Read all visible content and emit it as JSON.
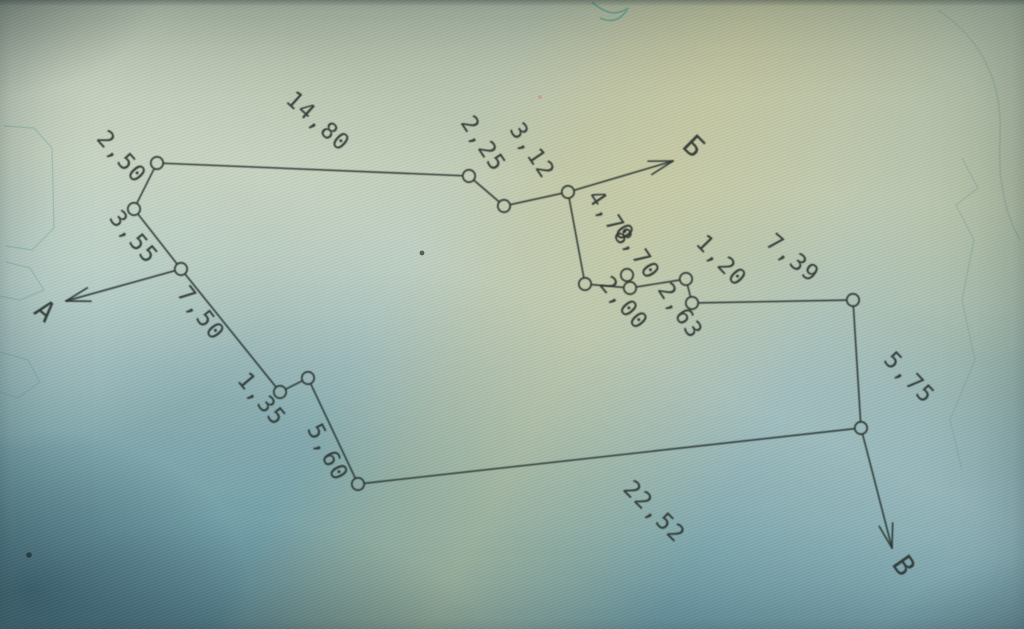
{
  "photo": {
    "ink_color": "#2c3531",
    "faint_mark_color": "#5f9e9b",
    "paper_tints": {
      "top_sage": "#bfcab4",
      "yellow_band": "#d3ca8e",
      "bottom_teal": "#6c98a3",
      "corner_shadow": "#102e3c"
    }
  },
  "diagram": {
    "type": "survey-traverse-sketch",
    "nodes": [
      {
        "id": "n1",
        "x": 157,
        "y": 163
      },
      {
        "id": "n2",
        "x": 134,
        "y": 209
      },
      {
        "id": "n3",
        "x": 181,
        "y": 269
      },
      {
        "id": "n4",
        "x": 469,
        "y": 176
      },
      {
        "id": "n5",
        "x": 504,
        "y": 206
      },
      {
        "id": "n6",
        "x": 568,
        "y": 192
      },
      {
        "id": "n7",
        "x": 585,
        "y": 284
      },
      {
        "id": "n8",
        "x": 627,
        "y": 275
      },
      {
        "id": "n9",
        "x": 630,
        "y": 288
      },
      {
        "id": "n10",
        "x": 686,
        "y": 279
      },
      {
        "id": "n11",
        "x": 692,
        "y": 303
      },
      {
        "id": "n12",
        "x": 853,
        "y": 300
      },
      {
        "id": "n13",
        "x": 861,
        "y": 428
      },
      {
        "id": "n14",
        "x": 280,
        "y": 392
      },
      {
        "id": "n15",
        "x": 308,
        "y": 378
      },
      {
        "id": "n16",
        "x": 358,
        "y": 484
      }
    ],
    "edges": [
      {
        "from": "n1",
        "to": "n2",
        "label": "2,50",
        "lx": 116,
        "ly": 162,
        "rot": 48
      },
      {
        "from": "n2",
        "to": "n3",
        "label": "3,55",
        "lx": 128,
        "ly": 242,
        "rot": 50
      },
      {
        "from": "n3",
        "to": "n14",
        "label": "7,50",
        "lx": 195,
        "ly": 318,
        "rot": 52
      },
      {
        "from": "n14",
        "to": "n15",
        "label": "1,35",
        "lx": 256,
        "ly": 404,
        "rot": 50
      },
      {
        "from": "n15",
        "to": "n16",
        "label": "5,60",
        "lx": 321,
        "ly": 456,
        "rot": 62
      },
      {
        "from": "n16",
        "to": "n13",
        "label": "22,52",
        "lx": 649,
        "ly": 517,
        "rot": 45
      },
      {
        "from": "n1",
        "to": "n4",
        "label": "14,80",
        "lx": 313,
        "ly": 127,
        "rot": 42
      },
      {
        "from": "n4",
        "to": "n5",
        "label": "2,25",
        "lx": 477,
        "ly": 148,
        "rot": 56
      },
      {
        "from": "n5",
        "to": "n6",
        "label": "3,12",
        "lx": 526,
        "ly": 155,
        "rot": 56
      },
      {
        "from": "n6",
        "to": "n7",
        "label": "4,78",
        "lx": 604,
        "ly": 222,
        "rot": 56
      },
      {
        "from": "n7",
        "to": "n9",
        "label": "2,00",
        "lx": 618,
        "ly": 308,
        "rot": 50
      },
      {
        "from": "n9",
        "to": "n8",
        "label": "0,70",
        "lx": 631,
        "ly": 256,
        "rot": 56
      },
      {
        "from": "n9",
        "to": "n10",
        "label": "2,63",
        "lx": 674,
        "ly": 315,
        "rot": 56
      },
      {
        "from": "n10",
        "to": "n11",
        "label": "1,20",
        "lx": 716,
        "ly": 266,
        "rot": 46
      },
      {
        "from": "n11",
        "to": "n12",
        "label": "7,39",
        "lx": 788,
        "ly": 264,
        "rot": 40
      },
      {
        "from": "n12",
        "to": "n13",
        "label": "5,75",
        "lx": 904,
        "ly": 383,
        "rot": 46
      }
    ],
    "endpoints": [
      {
        "name": "a",
        "from": "n3",
        "tipx": 66,
        "tipy": 301,
        "label": "А",
        "lx": 39,
        "ly": 318,
        "rot": 40
      },
      {
        "name": "be",
        "from": "n6",
        "tipx": 673,
        "tipy": 161,
        "label": "Б",
        "lx": 687,
        "ly": 153,
        "rot": 45
      },
      {
        "name": "ve",
        "from": "n13",
        "tipx": 892,
        "tipy": 548,
        "label": "В",
        "lx": 896,
        "ly": 571,
        "rot": 55
      }
    ],
    "background_marks": {
      "left_contours": [
        [
          [
            4,
            126
          ],
          [
            34,
            128
          ],
          [
            52,
            148
          ],
          [
            54,
            228
          ],
          [
            32,
            250
          ],
          [
            6,
            246
          ]
        ],
        [
          [
            6,
            262
          ],
          [
            30,
            268
          ],
          [
            44,
            290
          ],
          [
            20,
            300
          ],
          [
            0,
            296
          ]
        ],
        [
          [
            0,
            352
          ],
          [
            28,
            360
          ],
          [
            40,
            382
          ],
          [
            18,
            398
          ],
          [
            0,
            392
          ]
        ]
      ],
      "right_jagged": [
        [
          962,
          158
        ],
        [
          978,
          188
        ],
        [
          956,
          205
        ],
        [
          974,
          240
        ],
        [
          962,
          300
        ],
        [
          975,
          360
        ],
        [
          950,
          420
        ],
        [
          962,
          470
        ]
      ],
      "topright_curve": "M 938 10 Q 1005 55 1000 140 Q 997 200 1020 240",
      "top_scribble": "M 592 2 Q 612 20 628 8 Q 618 26 600 18",
      "specks": [
        {
          "x": 422,
          "y": 253,
          "r": 2.4,
          "color": "#3a423e"
        },
        {
          "x": 29,
          "y": 555,
          "r": 2.8,
          "color": "#22343a"
        },
        {
          "x": 540,
          "y": 97,
          "r": 1.8,
          "color": "#c98f9a"
        }
      ]
    }
  }
}
